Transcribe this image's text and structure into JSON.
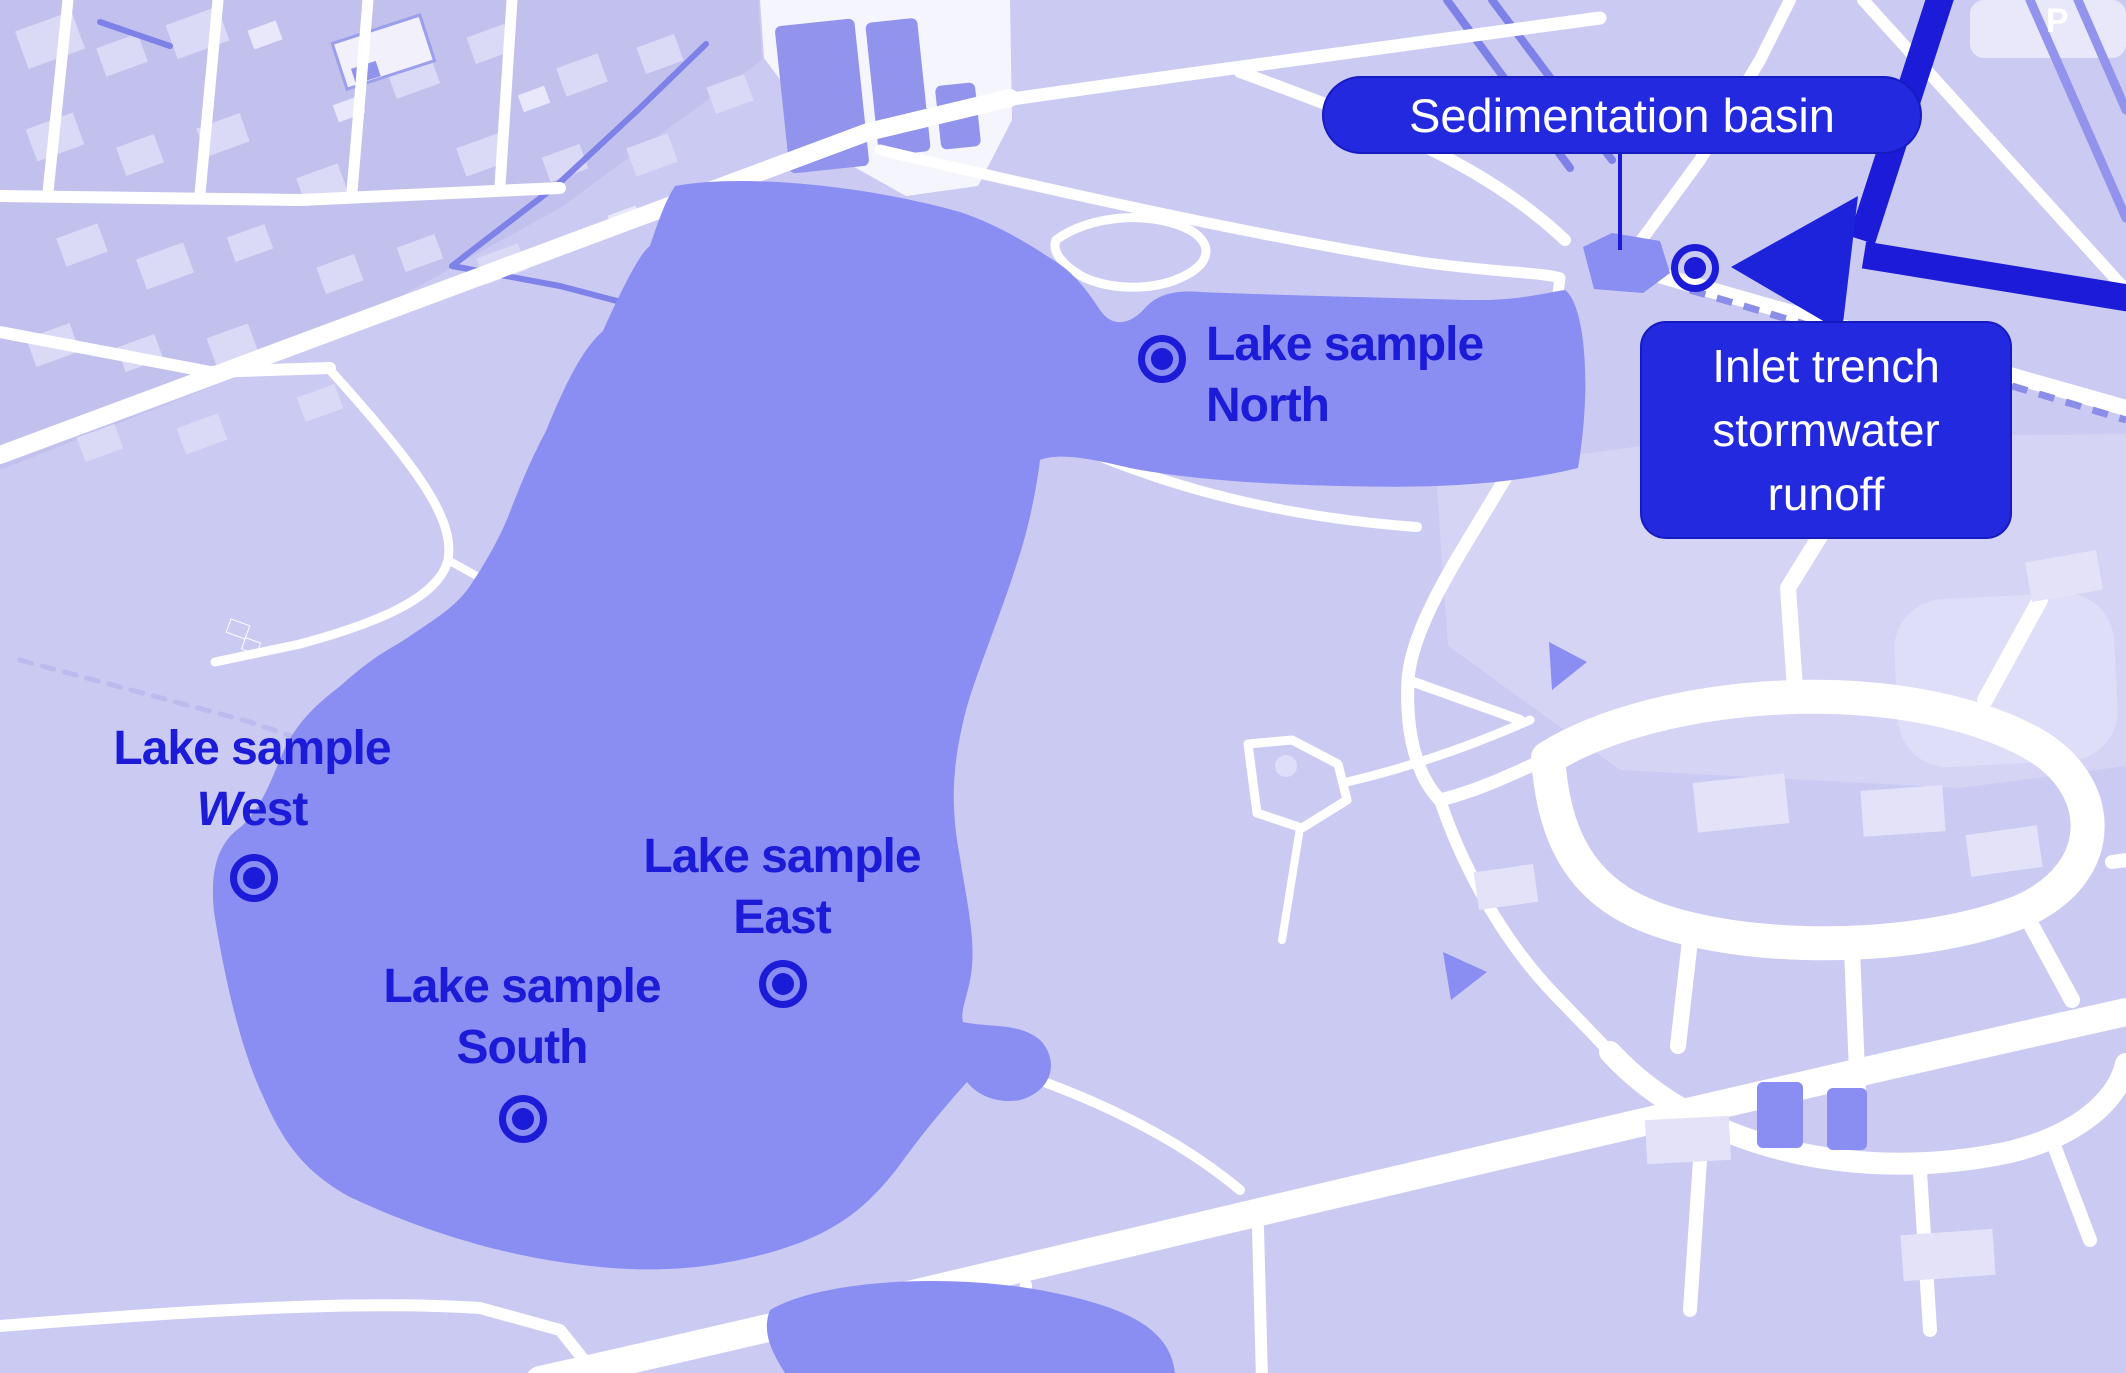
{
  "map": {
    "description": "Annotated lake map with water sampling sites, sedimentation basin and stormwater inlet trench",
    "colors": {
      "annotation_blue": "#1b1bd8",
      "callout_background": "#2329de",
      "callout_text": "#ffffff",
      "lake_water": "#8a8df1",
      "map_background": "#cbcaf3",
      "map_background_dark": "#c2c1ee",
      "road_white": "#ffffff",
      "stream": "#7d81e8",
      "parking_lot": "#9193ec"
    },
    "samples": {
      "north": {
        "line1": "Lake sample",
        "line2": "North"
      },
      "west": {
        "line1": "Lake sample",
        "line2_first": "W",
        "line2_rest": "est"
      },
      "east": {
        "line1": "Lake sample",
        "line2": "East"
      },
      "south": {
        "line1": "Lake sample",
        "line2": "South"
      }
    },
    "callouts": {
      "basin": {
        "label": "Sedimentation basin"
      },
      "inlet": {
        "lines": [
          "Inlet trench",
          "stormwater",
          "runoff"
        ]
      }
    },
    "icons": {
      "parking": "P"
    }
  }
}
